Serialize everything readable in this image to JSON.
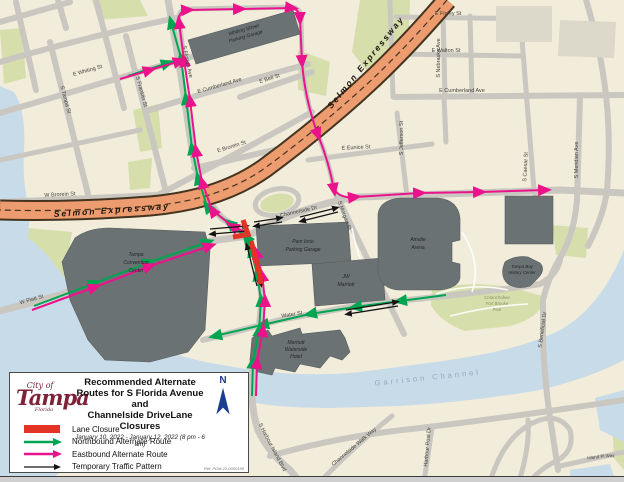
{
  "legend": {
    "logo": {
      "line1": "City of",
      "line2": "Tampa",
      "line3": "Florida"
    },
    "title_lines": [
      "Recommended Alternate",
      "Routes for S Florida Avenue and",
      "Channelside DriveLane Closures"
    ],
    "subtitle": "January 10, 2022 - January 12, 2022 (8 pm - 6 am)",
    "items": [
      {
        "key": "lane-closure",
        "label": "Lane Closure",
        "color": "#E23325",
        "type": "bar"
      },
      {
        "key": "northbound-alternate-route",
        "label": "Northbound Alternate Route",
        "color": "#00A551",
        "type": "arrow"
      },
      {
        "key": "eastbound-alternate-route",
        "label": "Eastbound Alternate Route",
        "color": "#EB138B",
        "type": "arrow"
      },
      {
        "key": "temporary-traffic-pattern",
        "label": "Temporary Traffic Pattern",
        "color": "#141414",
        "type": "arrow"
      }
    ],
    "north_label": "N",
    "ref_text": "Ref: PDM-22-0000199"
  },
  "map": {
    "colors": {
      "land": "#F2ECDB",
      "water": "#C8DBE8",
      "park": "#D6DFAC",
      "road": "#C9C7C0",
      "building": "#6B7274",
      "building_edge": "#565D5F",
      "light_block": "#DCD8CA",
      "expressway": "#EC9C6F",
      "expressway_edge": "#43331F",
      "closure": "#E23325",
      "northbound": "#00A551",
      "eastbound": "#EB138B",
      "temporary": "#141414"
    },
    "street_labels": [
      {
        "text": "E Whiting St"
      },
      {
        "text": "S Tampa St"
      },
      {
        "text": "S Franklin St"
      },
      {
        "text": "S Florida Ave"
      },
      {
        "text": "E Cumberland Ave"
      },
      {
        "text": "E Bell St"
      },
      {
        "text": "E Finley St"
      },
      {
        "text": "E Walton St"
      },
      {
        "text": "S Nebraska Ave"
      },
      {
        "text": "E Cumberland Ave"
      },
      {
        "text": "E Eunice St"
      },
      {
        "text": "S Jefferson St"
      },
      {
        "text": "S Morgan St"
      },
      {
        "text": "S Caesar St"
      },
      {
        "text": "S Meridian Ave"
      },
      {
        "text": "W Brorein St"
      },
      {
        "text": "E Brorein St"
      },
      {
        "text": "Channelside Dr"
      },
      {
        "text": "Water St"
      },
      {
        "text": "S Harbour Island Blvd"
      },
      {
        "text": "Channelside Walk Way"
      },
      {
        "text": "Harbour Post Dr"
      },
      {
        "text": "Island Pl Way"
      },
      {
        "text": "S Beneficial Dr"
      },
      {
        "text": "W Platt St"
      }
    ],
    "highway_labels": [
      {
        "text": "Selmon Expressway"
      },
      {
        "text": "Selmon Expressway"
      }
    ],
    "building_labels": [
      {
        "lines": [
          "Whiting Street",
          "Parking Garage"
        ]
      },
      {
        "lines": [
          "Tampa",
          "Convention",
          "Center"
        ]
      },
      {
        "lines": [
          "Pam Iorio",
          "Parking Garage"
        ]
      },
      {
        "lines": [
          "JW",
          "Marriott"
        ]
      },
      {
        "lines": [
          "Amalie",
          "Arena"
        ]
      },
      {
        "lines": [
          "Marriott",
          "Waterside",
          "Hotel"
        ]
      },
      {
        "lines": [
          "Tampa Bay",
          "History Center"
        ]
      },
      {
        "lines": [
          "Cotanchobee",
          "Fort Brooke",
          "Park"
        ]
      }
    ],
    "water_labels": [
      {
        "text": "Garrison Channel"
      }
    ]
  }
}
